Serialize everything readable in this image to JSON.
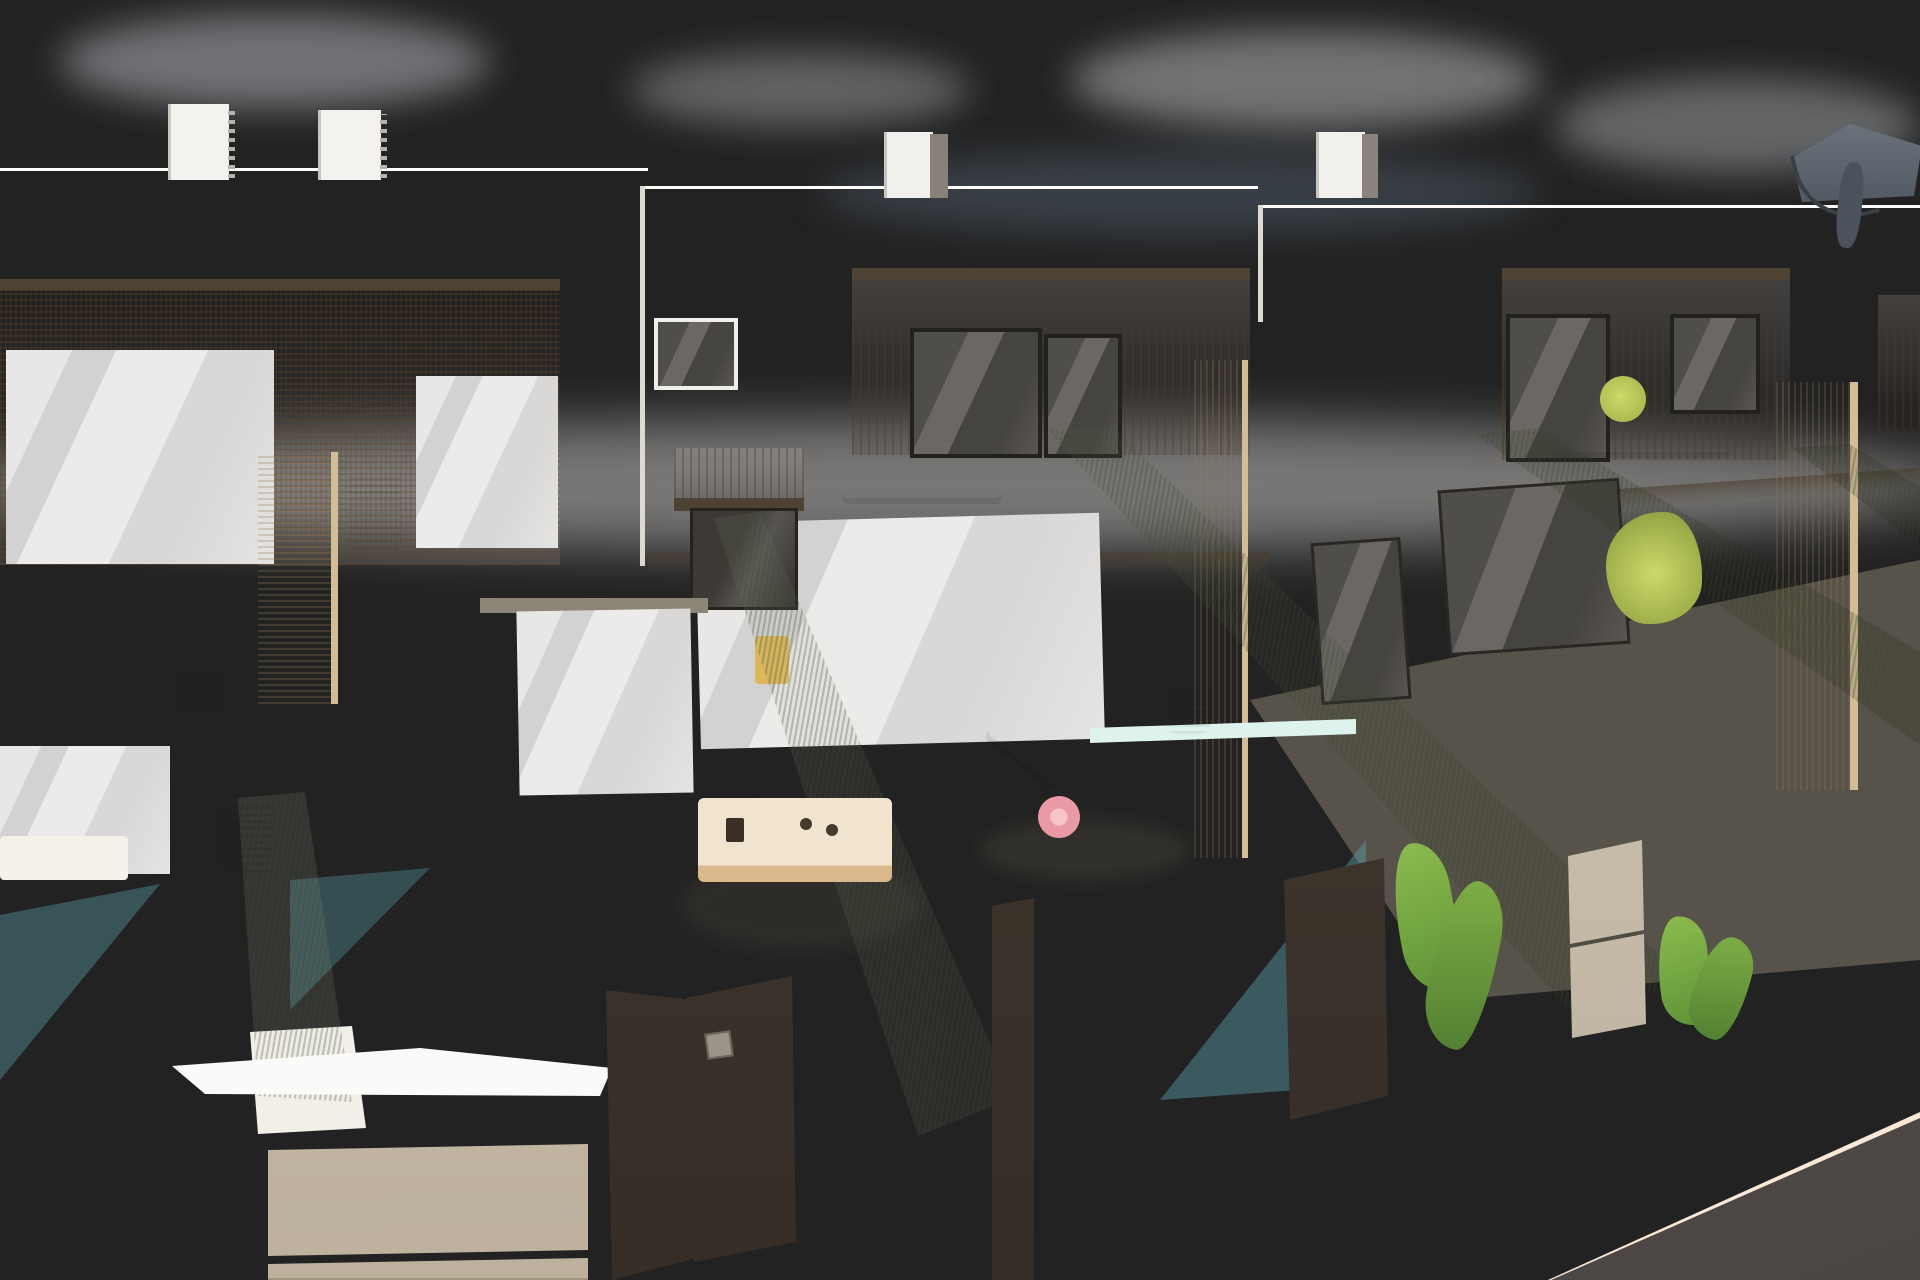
{
  "meta": {
    "type": "architectural-3d-render",
    "subject": "Row of modern white two-storey townhouses with rooftop solariums, wood-slat accents, private plunge pools, artificial-grass privacy hedges and dark slatted street gates",
    "visible_text": "none"
  },
  "palette": {
    "sky_top": "#7a8ea6",
    "sky_mid": "#8b9cab",
    "sky_horizon": "#d8d9da",
    "cloud": "#d3dae1",
    "wall_bright": "#f7f6f3",
    "wall_shade": "#e9e7e2",
    "wall_dark": "#d9d5cf",
    "lattice": "#c79d72",
    "wood_slat": "#c0915e",
    "travertine": "#e9dab9",
    "frame_dark": "#32302b",
    "hedge": "#8b9a5e",
    "hedge_dark": "#6e7c47",
    "pool": "#aee4e3",
    "pool_deep": "#8fd6d6",
    "pool_shadow": "#7cc3c8",
    "pool_bright": "#cdefe9",
    "fence": "#453c33",
    "floor_cream": "#f1ece2",
    "paving": "#f2dfca",
    "paving_line": "#e4ccb3",
    "road": "#575150",
    "cushion": "#f1efe9",
    "rattan": "#d0a368",
    "wood_furn": "#c9a06b",
    "towel_pink": "#e897a0",
    "towel_pink_light": "#f3bdc1",
    "towel_lime": "#d9e24f",
    "plant": "#6f9a53",
    "plant_dark": "#4f7a3e",
    "plant_light": "#9cbf6e",
    "flower_pink": "#e4799b",
    "parasol": "#59616b",
    "metal_panel": "#cfc4b4"
  },
  "scene_objects": [
    {
      "name": "rooftop-solarium-boxes",
      "count": 4
    },
    {
      "name": "white-townhouse-facades",
      "count": 4
    },
    {
      "name": "wood-slat-cladding-bands",
      "count": 3
    },
    {
      "name": "balconies-with-black-railings",
      "count": 4
    },
    {
      "name": "privacy-hedges",
      "count": 5
    },
    {
      "name": "plunge-pools",
      "count": 3
    },
    {
      "name": "sun-loungers",
      "count": 2
    },
    {
      "name": "outdoor-dining-set",
      "count": 1
    },
    {
      "name": "street-gates-and-fences",
      "count": 6
    },
    {
      "name": "utility-pillars-with-metal-panels",
      "count": 2
    },
    {
      "name": "herringbone-sidewalk",
      "count": 1
    },
    {
      "name": "asphalt-road",
      "count": 1
    },
    {
      "name": "roof-parasol",
      "count": 1
    },
    {
      "name": "potted-plants",
      "count": 10
    }
  ]
}
